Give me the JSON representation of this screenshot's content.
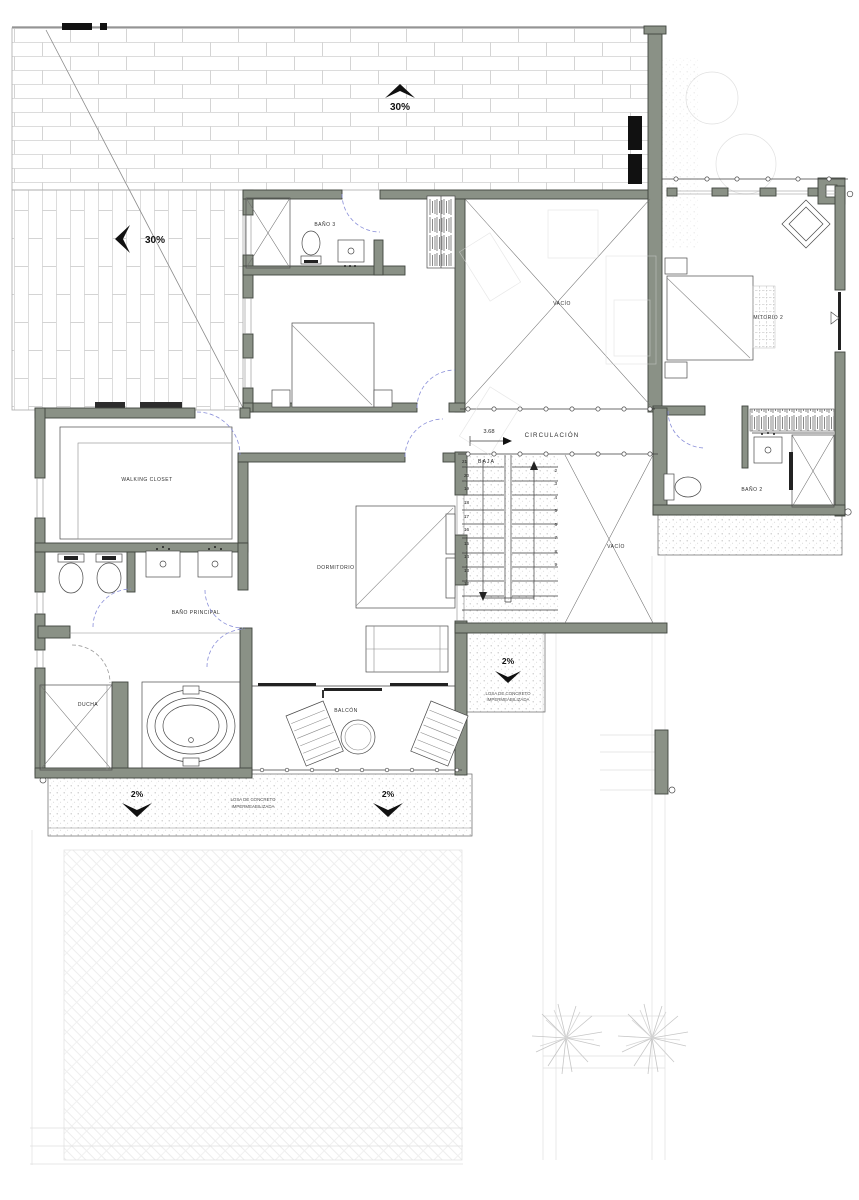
{
  "colors": {
    "wall": "#8a9186",
    "door_arc": "#8a8fd9",
    "ink": "#3a3a3a"
  },
  "roof": {
    "slope_top": "30%",
    "slope_left": "30%"
  },
  "rooms": {
    "bano3": "BAÑO 3",
    "dormitorio3": "DORMITORIO 3",
    "vacio": "VACÍO",
    "vacio_stair": "VACÍO",
    "dormitorio2": "DORMITORIO 2",
    "bano2": "BAÑO 2",
    "walking_closet": "WALKING CLOSET",
    "dormitorio_principal": "DORMITORIO PRINCIPAL",
    "bano_principal": "BAÑO PRINCIPAL",
    "ducha": "DUCHA",
    "balcon": "BALCÓN"
  },
  "circulation": {
    "label": "CIRCULACIÓN",
    "dimension": "3.68"
  },
  "stairs": {
    "baja": "BAJA",
    "start": "21",
    "left": [
      "20",
      "19",
      "18",
      "17",
      "16",
      "15",
      "14",
      "13",
      "12"
    ],
    "right": [
      "2",
      "3",
      "4",
      "5",
      "6",
      "7",
      "8",
      "9"
    ]
  },
  "slopes": {
    "terrace": "2%"
  },
  "notes": {
    "slab_line1": "LOSA DE CONCRETO",
    "slab_line2": "IMPERMEABILIZADA"
  }
}
